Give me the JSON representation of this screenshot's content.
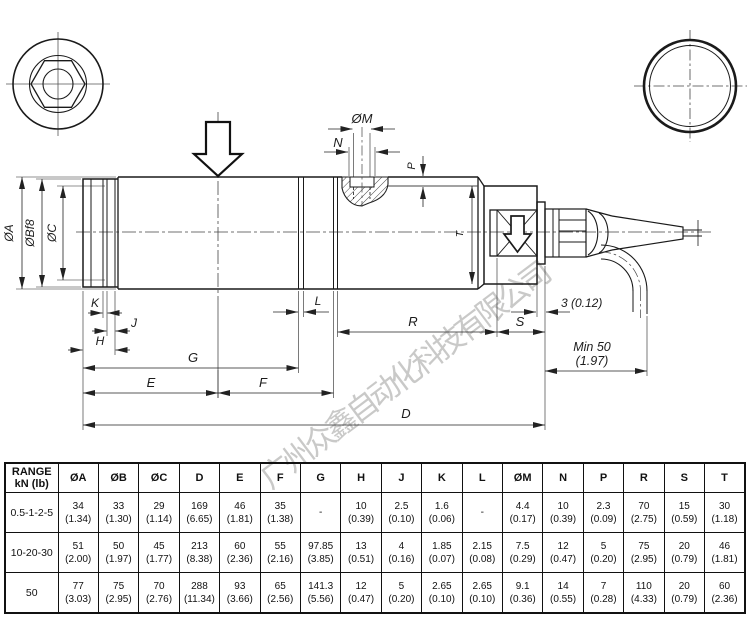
{
  "drawing": {
    "watermark": "广州众鑫自动化科技有限公司",
    "labels": {
      "dia_a": "ØA",
      "dia_b": "ØBf8",
      "dia_c": "ØC",
      "k": "K",
      "j": "J",
      "h": "H",
      "g": "G",
      "e": "E",
      "f": "F",
      "d": "D",
      "l": "L",
      "r": "R",
      "s": "S",
      "t": "T",
      "dia_m": "ØM",
      "n": "N",
      "p": "P",
      "flange_thickness": "3 (0.12)",
      "min_bend_1": "Min 50",
      "min_bend_2": "(1.97)"
    }
  },
  "table": {
    "range_title": "RANGE",
    "range_unit": "kN (lb)",
    "columns": [
      "ØA",
      "ØB",
      "ØC",
      "D",
      "E",
      "F",
      "G",
      "H",
      "J",
      "K",
      "L",
      "ØM",
      "N",
      "P",
      "R",
      "S",
      "T"
    ],
    "rows": [
      {
        "range": "0.5-1-2-5",
        "cells": [
          {
            "mm": "34",
            "in": "(1.34)"
          },
          {
            "mm": "33",
            "in": "(1.30)"
          },
          {
            "mm": "29",
            "in": "(1.14)"
          },
          {
            "mm": "169",
            "in": "(6.65)"
          },
          {
            "mm": "46",
            "in": "(1.81)"
          },
          {
            "mm": "35",
            "in": "(1.38)"
          },
          {
            "mm": "-",
            "in": ""
          },
          {
            "mm": "10",
            "in": "(0.39)"
          },
          {
            "mm": "2.5",
            "in": "(0.10)"
          },
          {
            "mm": "1.6",
            "in": "(0.06)"
          },
          {
            "mm": "-",
            "in": ""
          },
          {
            "mm": "4.4",
            "in": "(0.17)"
          },
          {
            "mm": "10",
            "in": "(0.39)"
          },
          {
            "mm": "2.3",
            "in": "(0.09)"
          },
          {
            "mm": "70",
            "in": "(2.75)"
          },
          {
            "mm": "15",
            "in": "(0.59)"
          },
          {
            "mm": "30",
            "in": "(1.18)"
          }
        ]
      },
      {
        "range": "10-20-30",
        "cells": [
          {
            "mm": "51",
            "in": "(2.00)"
          },
          {
            "mm": "50",
            "in": "(1.97)"
          },
          {
            "mm": "45",
            "in": "(1.77)"
          },
          {
            "mm": "213",
            "in": "(8.38)"
          },
          {
            "mm": "60",
            "in": "(2.36)"
          },
          {
            "mm": "55",
            "in": "(2.16)"
          },
          {
            "mm": "97.85",
            "in": "(3.85)"
          },
          {
            "mm": "13",
            "in": "(0.51)"
          },
          {
            "mm": "4",
            "in": "(0.16)"
          },
          {
            "mm": "1.85",
            "in": "(0.07)"
          },
          {
            "mm": "2.15",
            "in": "(0.08)"
          },
          {
            "mm": "7.5",
            "in": "(0.29)"
          },
          {
            "mm": "12",
            "in": "(0.47)"
          },
          {
            "mm": "5",
            "in": "(0.20)"
          },
          {
            "mm": "75",
            "in": "(2.95)"
          },
          {
            "mm": "20",
            "in": "(0.79)"
          },
          {
            "mm": "46",
            "in": "(1.81)"
          }
        ]
      },
      {
        "range": "50",
        "cells": [
          {
            "mm": "77",
            "in": "(3.03)"
          },
          {
            "mm": "75",
            "in": "(2.95)"
          },
          {
            "mm": "70",
            "in": "(2.76)"
          },
          {
            "mm": "288",
            "in": "(11.34)"
          },
          {
            "mm": "93",
            "in": "(3.66)"
          },
          {
            "mm": "65",
            "in": "(2.56)"
          },
          {
            "mm": "141.3",
            "in": "(5.56)"
          },
          {
            "mm": "12",
            "in": "(0.47)"
          },
          {
            "mm": "5",
            "in": "(0.20)"
          },
          {
            "mm": "2.65",
            "in": "(0.10)"
          },
          {
            "mm": "2.65",
            "in": "(0.10)"
          },
          {
            "mm": "9.1",
            "in": "(0.36)"
          },
          {
            "mm": "14",
            "in": "(0.55)"
          },
          {
            "mm": "7",
            "in": "(0.28)"
          },
          {
            "mm": "110",
            "in": "(4.33)"
          },
          {
            "mm": "20",
            "in": "(0.79)"
          },
          {
            "mm": "60",
            "in": "(2.36)"
          }
        ]
      }
    ]
  }
}
